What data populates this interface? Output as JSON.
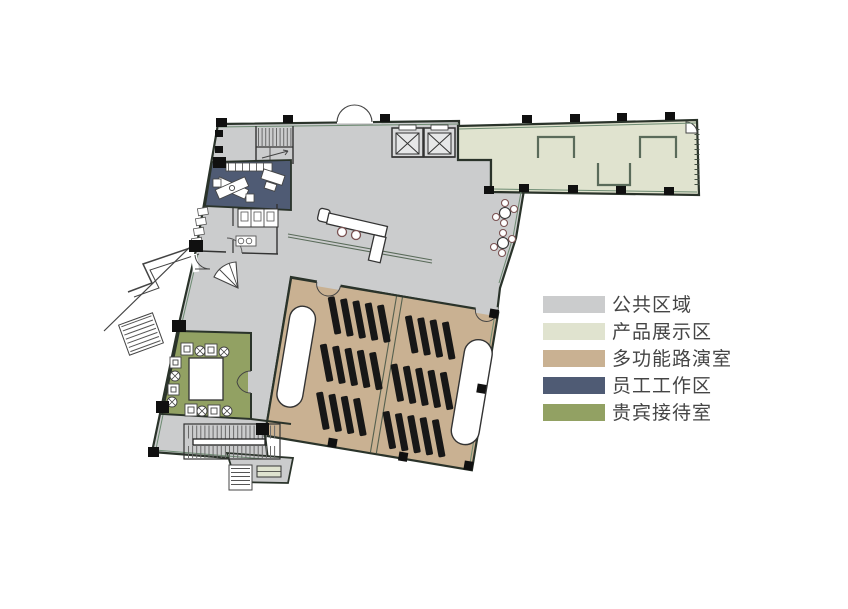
{
  "legend": {
    "items": [
      {
        "key": "public-area",
        "label": "公共区域",
        "color": "#cbcccd"
      },
      {
        "key": "product-display-area",
        "label": "产品展示区",
        "color": "#e0e3cf"
      },
      {
        "key": "multifunction-roadshow-room",
        "label": "多功能路演室",
        "color": "#c9b192"
      },
      {
        "key": "staff-work-area",
        "label": "员工工作区",
        "color": "#4f5b74"
      },
      {
        "key": "vip-reception-room",
        "label": "贵宾接待室",
        "color": "#92a163"
      }
    ]
  },
  "plan": {
    "regions": [
      {
        "name": "public-area"
      },
      {
        "name": "product-display-area"
      },
      {
        "name": "multifunction-roadshow-room"
      },
      {
        "name": "staff-work-area"
      },
      {
        "name": "vip-reception-room"
      }
    ]
  }
}
